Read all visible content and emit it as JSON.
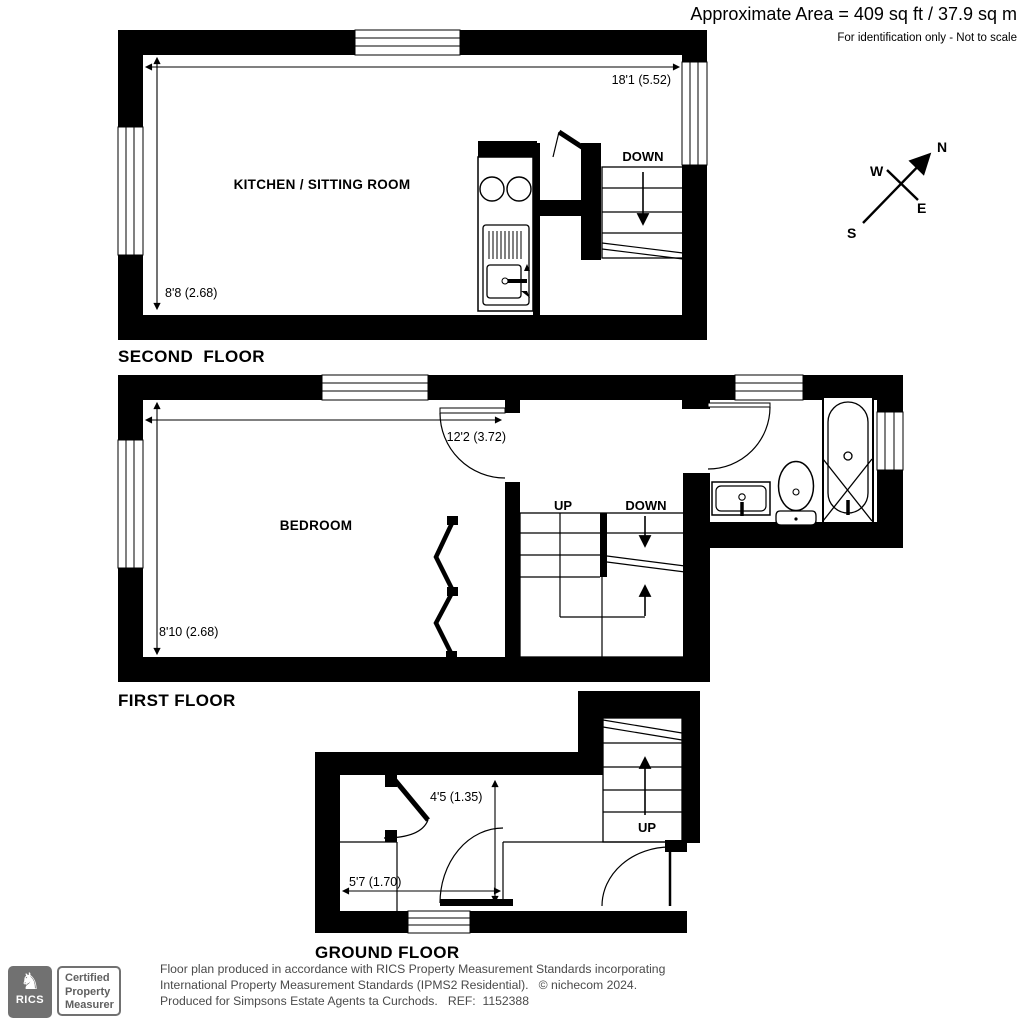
{
  "header": {
    "area_text": "Approximate Area = 409 sq ft / 37.9 sq m",
    "disclaimer": "For identification only - Not to scale"
  },
  "compass": {
    "north": "N",
    "east": "E",
    "south": "S",
    "west": "W"
  },
  "floors": {
    "second": {
      "label": "SECOND  FLOOR",
      "room": "KITCHEN / SITTING ROOM",
      "width_dim": "18'1 (5.52)",
      "height_dim": "8'8 (2.68)",
      "stair": "DOWN"
    },
    "first": {
      "label": "FIRST FLOOR",
      "room": "BEDROOM",
      "width_dim": "12'2 (3.72)",
      "height_dim": "8'10 (2.68)",
      "stair_up": "UP",
      "stair_down": "DOWN"
    },
    "ground": {
      "label": "GROUND FLOOR",
      "width_dim": "5'7 (1.70)",
      "height_dim": "4'5 (1.35)",
      "stair": "UP"
    }
  },
  "footer": {
    "badge": {
      "org": "RICS",
      "cert": [
        "Certified",
        "Property",
        "Measurer"
      ]
    },
    "line1": "Floor plan produced in accordance with RICS Property Measurement Standards incorporating",
    "line2": "International Property Measurement Standards (IPMS2 Residential).   © nichecom 2024.",
    "line3": "Produced for Simpsons Estate Agents ta Curchods.   REF:  1152388"
  }
}
